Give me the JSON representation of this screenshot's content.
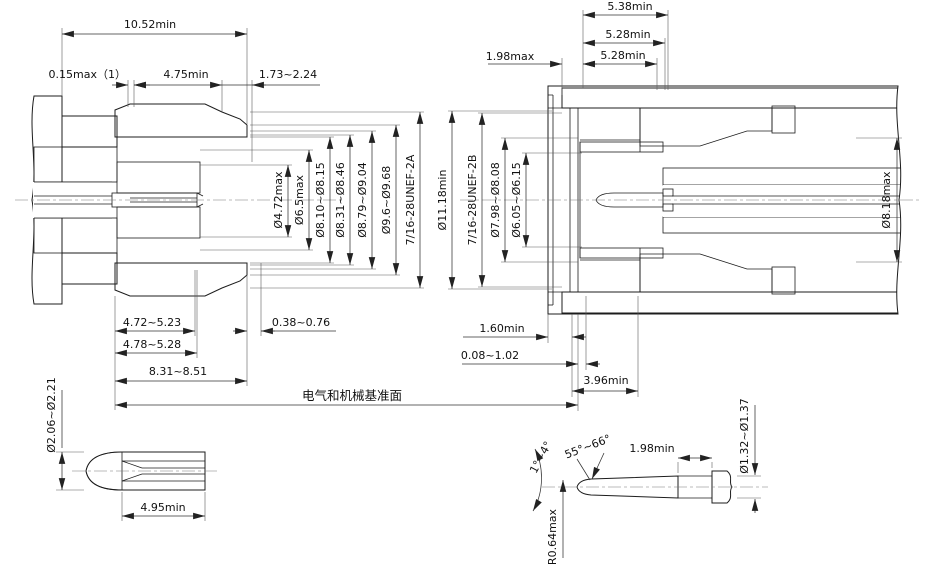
{
  "fig_left": {
    "top": {
      "overall": "10.52min",
      "lip": "0.15max（1）",
      "nut_len": "4.75min",
      "recess": "1.73~2.24"
    },
    "dia": {
      "d1": "Ø4.72max",
      "d2": "Ø6.5max",
      "d3": "Ø8.10~Ø8.15",
      "d4": "Ø8.31~Ø8.46",
      "d5": "Ø8.79~Ø9.04",
      "d6": "Ø9.6~Ø9.68",
      "thread": "7/16-28UNEF-2A"
    },
    "bottom": {
      "b1": "4.72~5.23",
      "b2": "4.78~5.28",
      "b3": "8.31~8.51",
      "b4": "0.38~0.76"
    }
  },
  "fig_right": {
    "top": {
      "t1": "5.38min",
      "t2": "5.28min",
      "t3": "5.28min",
      "t4": "1.98max"
    },
    "dia": {
      "d1": "Ø11.18min",
      "thread": "7/16-28UNEF-2B",
      "d2": "Ø7.98~Ø8.08",
      "d3": "Ø6.05~Ø6.15",
      "d4": "Ø8.18max"
    },
    "bottom": {
      "b1": "1.60min",
      "b2": "0.08~1.02",
      "b3": "3.96min"
    }
  },
  "ref_plane": "电气和机械基准面",
  "socket_detail": {
    "dia": "Ø2.06~Ø2.21",
    "len": "4.95min"
  },
  "pin_detail": {
    "taper": "1°~4°",
    "tip_angle": "55°~66°",
    "len": "1.98min",
    "radius": "R0.64max",
    "dia": "Ø1.32~Ø1.37"
  }
}
